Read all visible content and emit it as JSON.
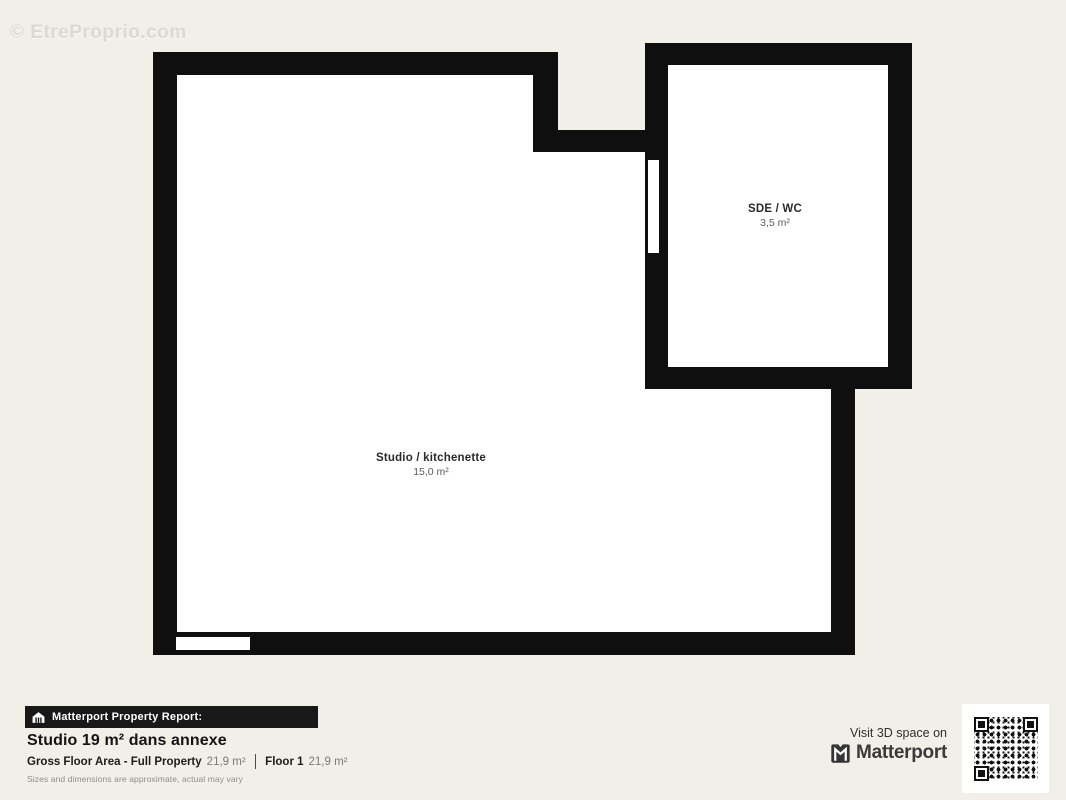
{
  "watermark": "© EtreProprio.com",
  "colors": {
    "background": "#f2efe9",
    "wall": "#0f0f0f",
    "room_fill": "#ffffff",
    "bar_background": "#181818",
    "bar_text": "#ffffff"
  },
  "floorplan": {
    "rooms": [
      {
        "name": "Studio / kitchenette",
        "area": "15,0 m²"
      },
      {
        "name": "SDE / WC",
        "area": "3,5 m²"
      }
    ]
  },
  "report": {
    "badge": "Matterport Property Report:",
    "title": "Studio 19 m² dans annexe",
    "stats": [
      {
        "label": "Gross Floor Area - Full Property",
        "value": "21,9 m²"
      },
      {
        "label": "Floor 1",
        "value": "21,9 m²"
      }
    ],
    "disclaimer": "Sizes and dimensions are approximate, actual may vary"
  },
  "cta": {
    "line": "Visit 3D space on",
    "brand": "Matterport"
  },
  "icons": {
    "house": "house-icon",
    "matterport_mark": "matterport-logo-icon",
    "qr": "qr-code"
  }
}
